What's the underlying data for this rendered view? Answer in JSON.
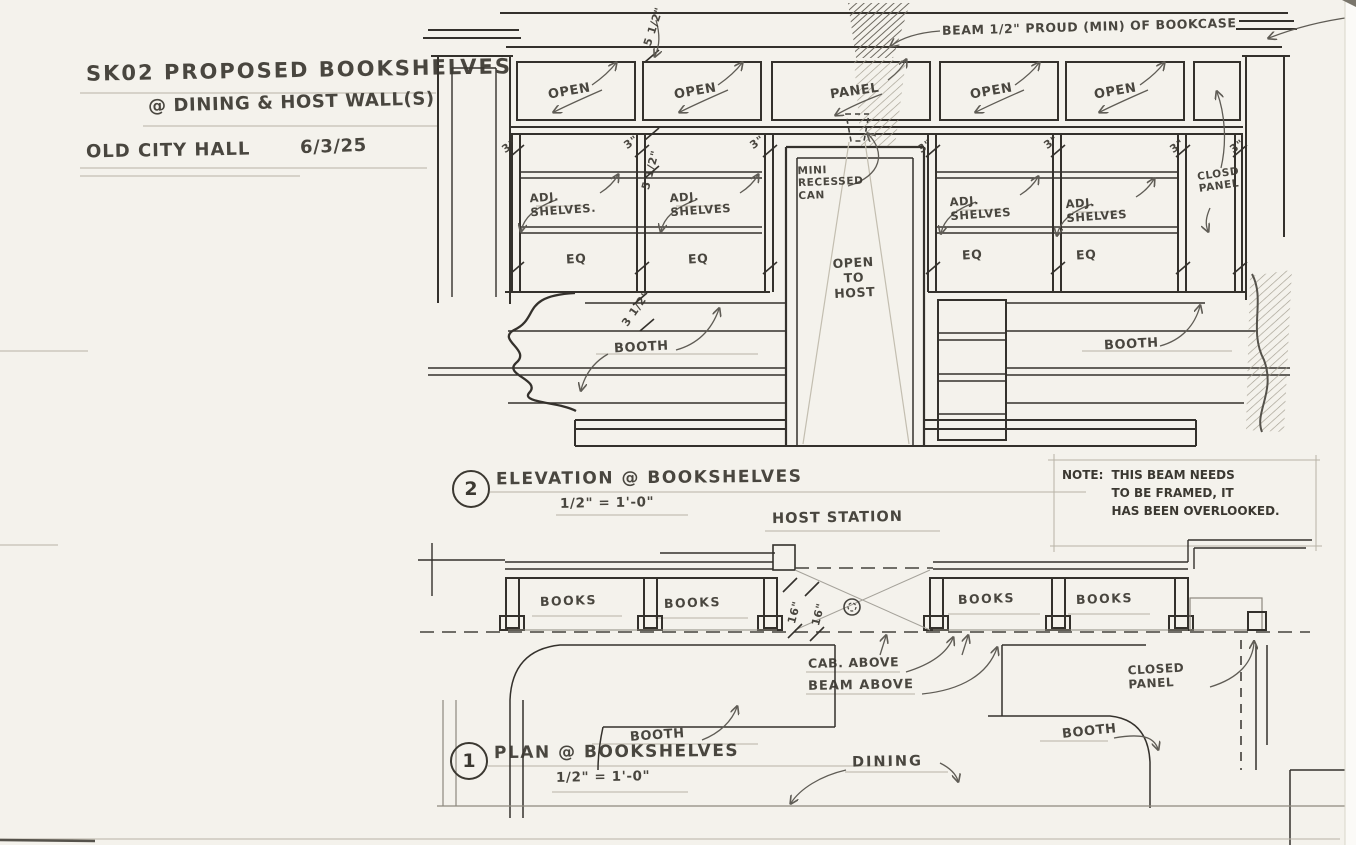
{
  "title_block": {
    "sketch_title": "SK02 PROPOSED BOOKSHELVES",
    "sketch_subtitle": "@ DINING & HOST WALL(S)",
    "project": "OLD CITY HALL",
    "date": "6/3/25"
  },
  "elevation": {
    "drawing_number": "2",
    "title": "ELEVATION @ BOOKSHELVES",
    "scale": "1/2\" = 1'-0\"",
    "beam_note": "BEAM 1/2\" PROUD (MIN) OF BOOKCASE",
    "bays": [
      "OPEN",
      "OPEN",
      "PANEL",
      "OPEN",
      "OPEN"
    ],
    "adj_shelves": [
      "ADJ.\nSHELVES.",
      "ADJ.\nSHELVES",
      "ADJ.\nSHELVES",
      "ADJ.\nSHELVES"
    ],
    "eq": [
      "EQ",
      "EQ",
      "EQ",
      "EQ"
    ],
    "mini_can": "MINI\nRECESSED\nCAN",
    "open_to_host": "OPEN\nTO\nHOST",
    "closed_panel": "CLOSD\nPANEL",
    "booths": [
      "BOOTH",
      "BOOTH"
    ],
    "dims": {
      "top": "5 1/2\"",
      "shelf": "5 1/2\"",
      "bottom": "3 1/2\"",
      "stiles": [
        "3\"",
        "3\"",
        "3\"",
        "3\"",
        "3\"",
        "3\"",
        "3\""
      ]
    }
  },
  "note": {
    "label": "NOTE:",
    "body": "THIS BEAM NEEDS\nTO BE FRAMED, IT\nHAS BEEN OVERLOOKED."
  },
  "plan": {
    "drawing_number": "1",
    "title": "PLAN @ BOOKSHELVES",
    "scale": "1/2\" = 1'-0\"",
    "host_station": "HOST STATION",
    "books": [
      "BOOKS",
      "BOOKS",
      "BOOKS",
      "BOOKS"
    ],
    "cab_above": "CAB. ABOVE",
    "beam_above": "BEAM ABOVE",
    "closed_panel": "CLOSED\nPANEL",
    "booths": [
      "BOOTH",
      "BOOTH"
    ],
    "dining": "DINING",
    "dims": [
      "16\"",
      "16\""
    ]
  }
}
